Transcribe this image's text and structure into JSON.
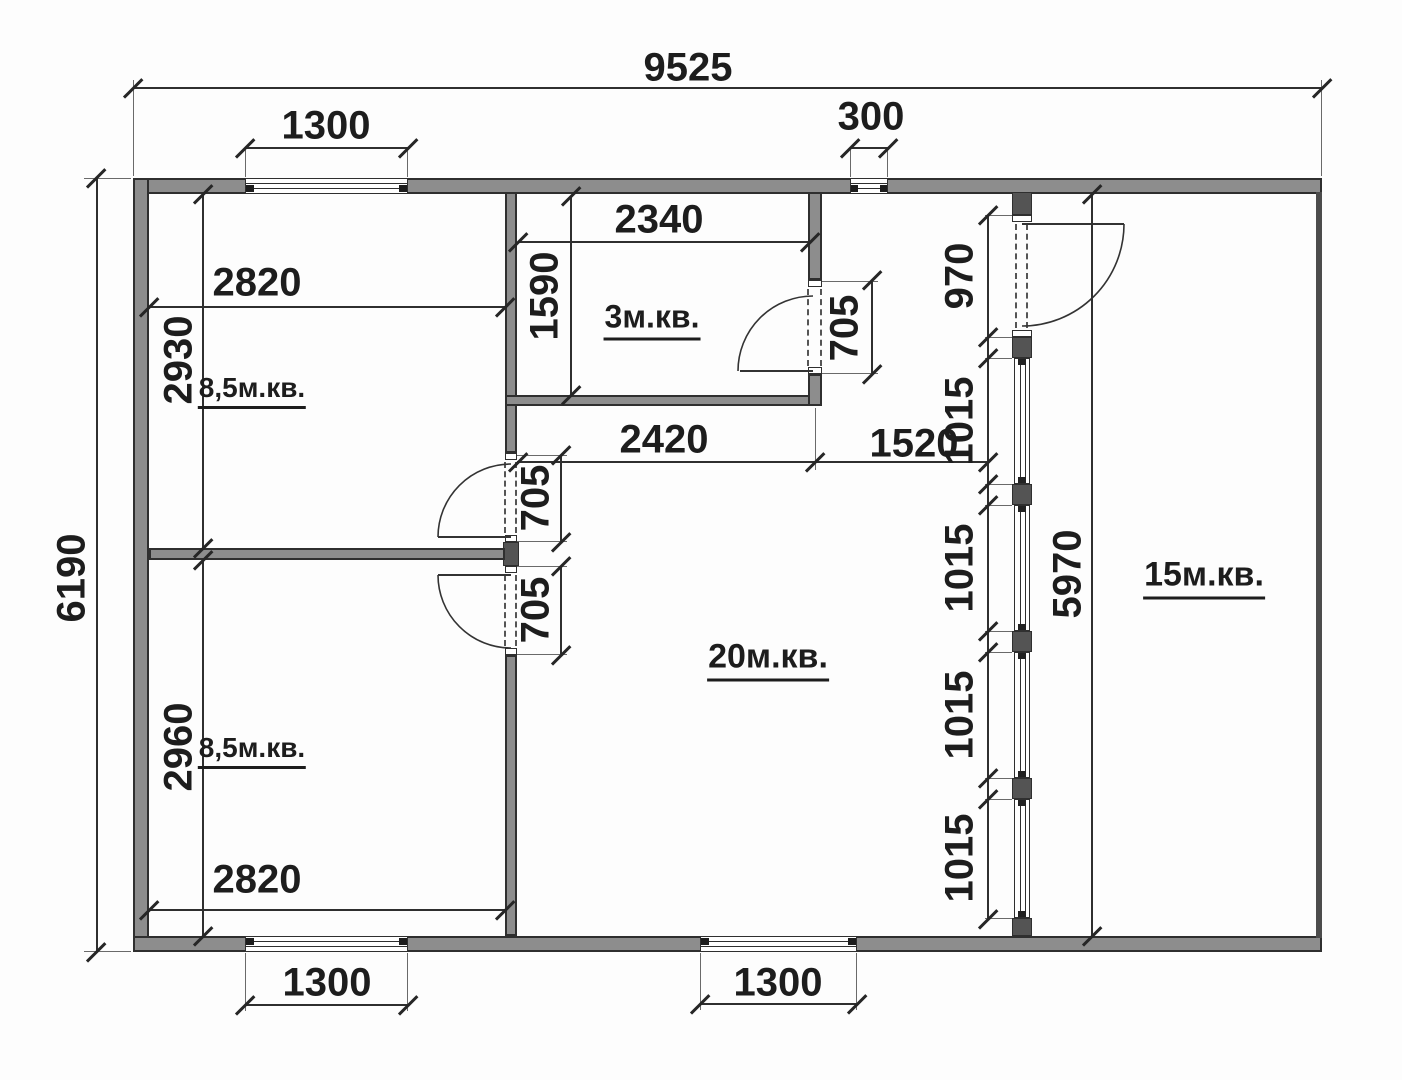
{
  "floorplan": {
    "rooms": [
      {
        "label": "8,5м.кв."
      },
      {
        "label": "8,5м.кв."
      },
      {
        "label": "3м.кв."
      },
      {
        "label": "20м.кв."
      },
      {
        "label": "15м.кв."
      }
    ],
    "dims": {
      "total_width": "9525",
      "total_height": "6190",
      "top_window": "1300",
      "top_vent": "300",
      "room_tl_w": "2820",
      "room_tl_h": "2930",
      "room3_w": "2340",
      "room3_h": "1590",
      "door3": "705",
      "door_tl": "705",
      "door_bl": "705",
      "hall_a": "2420",
      "hall_b": "1520",
      "door_part": "970",
      "glz1": "1015",
      "glz2": "1015",
      "glz3": "1015",
      "glz4": "1015",
      "part_h": "5970",
      "room_bl_h": "2960",
      "room_bl_w": "2820",
      "win_bl": "1300",
      "win_bc": "1300"
    }
  }
}
